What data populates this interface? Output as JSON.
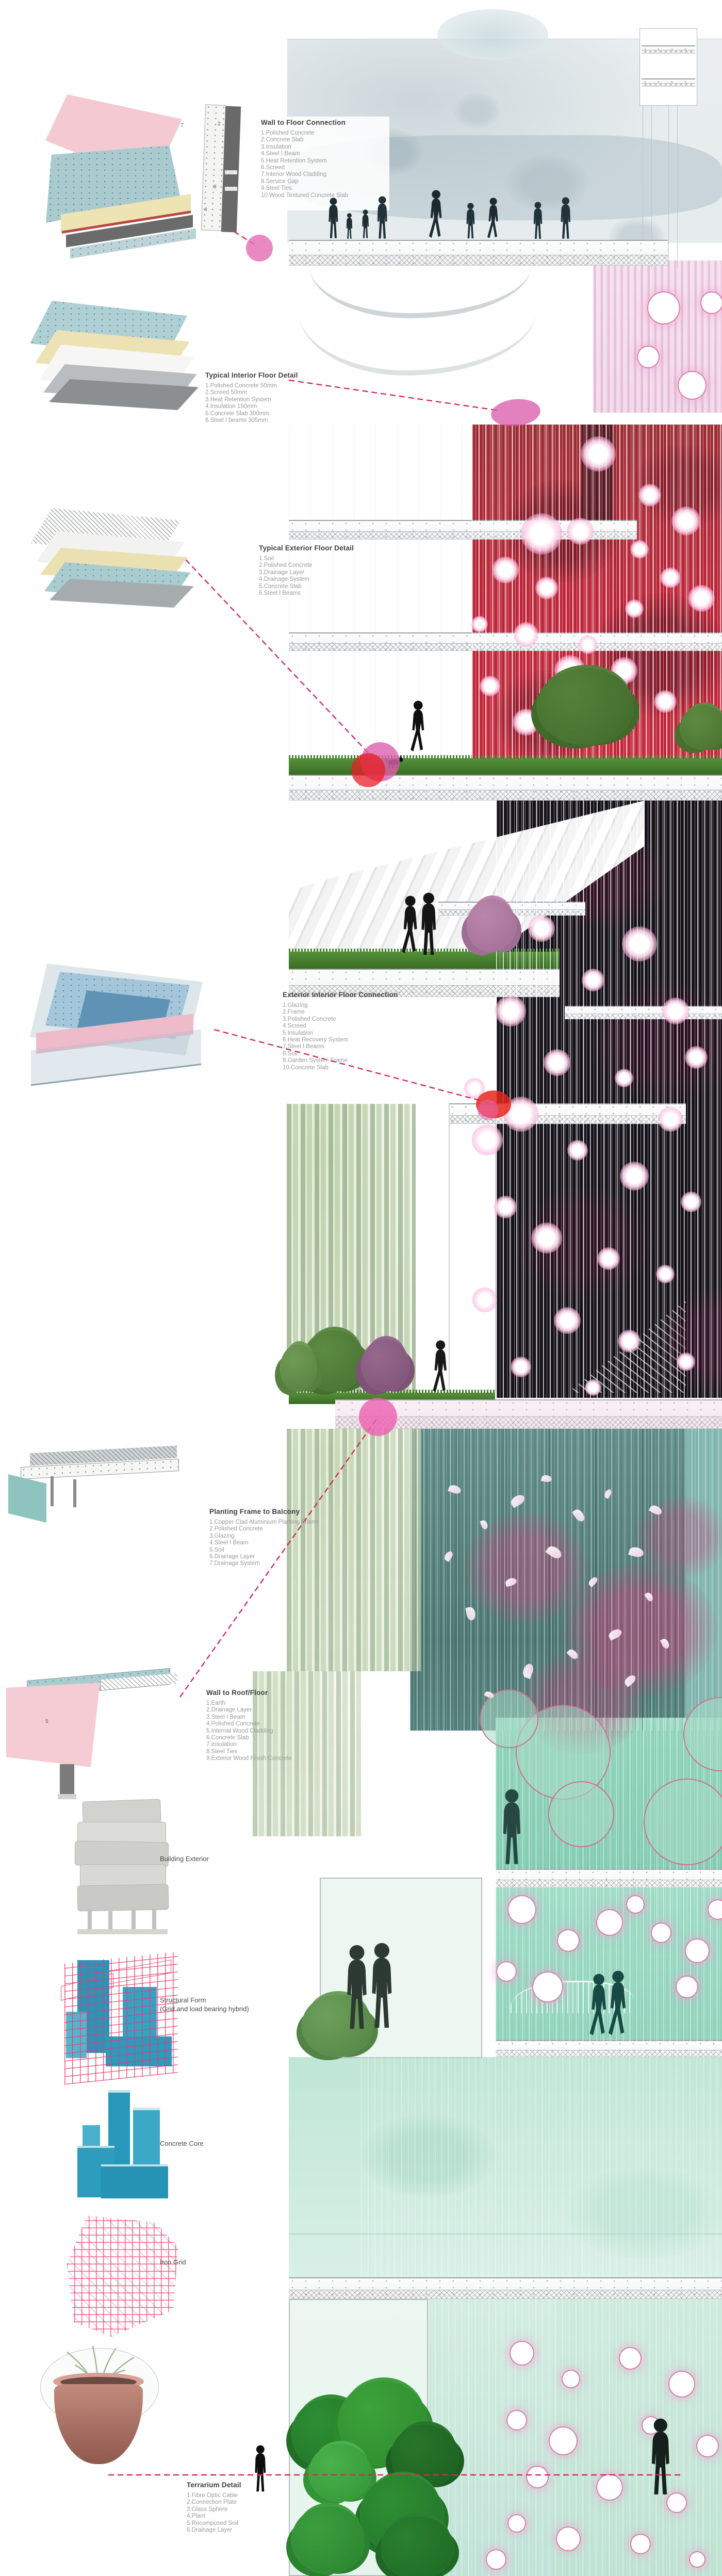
{
  "details": [
    {
      "id": "wall-floor",
      "title": "Wall to Floor Connection",
      "items": [
        "1.Polished Concrete",
        "2.Concrete Slab",
        "3.Insulation",
        "4.Steel I Beam",
        "5.Heat Retention System",
        "6.Screed",
        "7.Interior Wood Cladding",
        "8.Service Gap",
        "9.Steel Ties",
        "10.Wood Textured Concrete Slab"
      ],
      "figure_numbers": [
        "7",
        "2",
        "9",
        "4"
      ]
    },
    {
      "id": "interior-floor",
      "title": "Typical Interior Floor Detail",
      "items": [
        "1.Polished Concrete 50mm",
        "2.Screed 50mm",
        "3.Heat Retention System",
        "4.Insulation 150mm",
        "5.Concrete Slab 300mm",
        "6.Steel I beams 305mm"
      ],
      "figure_numbers": []
    },
    {
      "id": "exterior-floor",
      "title": "Typical Exterior Floor Detail",
      "items": [
        "1.Soil",
        "2.Polished Concrete",
        "3.Drainage Layer",
        "4.Drainage System",
        "5.Concrete Slab",
        "6.Steel I Beams"
      ],
      "figure_numbers": []
    },
    {
      "id": "ext-int-connection",
      "title": "Exterior Interior Floor Connection",
      "items": [
        "1.Glazing",
        "2.Frame",
        "3.Polished Concrete",
        "4.Screed",
        "5.Insulation",
        "6.Heat Recovery System",
        "7.Steel I Beams",
        "8.Soil",
        "9.Garden System Frame",
        "10.Concrete Slab"
      ],
      "figure_numbers": []
    },
    {
      "id": "planting-frame",
      "title": "Planting Frame to Balcony",
      "items": [
        "1.Copper Clad Aluminium Planting Frame",
        "2.Polished Concrete",
        "3.Glazing",
        "4.Steel I Beam",
        "5.Soil",
        "6.Drainage Layer",
        "7.Drainage System"
      ],
      "figure_numbers": []
    },
    {
      "id": "wall-roof",
      "title": "Wall to Roof/Floor",
      "items": [
        "1.Earth",
        "2.Drainage Layer",
        "3.Steel I Beam",
        "4.Polished Concrete",
        "5.Internal Wood Cladding",
        "6.Concrete Slab",
        "7.Insulation",
        "8.Steel Ties",
        "9.Exterior Wood Finish Concrete"
      ],
      "figure_numbers": [
        "5"
      ]
    },
    {
      "id": "terrarium",
      "title": "Terrarium Detail",
      "items": [
        "1.Fibre Optic Cable",
        "2.Connection Plate",
        "3.Glass Sphere",
        "4.Plant",
        "5.Recomposed Soil",
        "6.Drainage Layer"
      ],
      "figure_numbers": []
    }
  ],
  "axon_stack": [
    {
      "label": "Building Exterior",
      "sublabel": ""
    },
    {
      "label": "Structural Form",
      "sublabel": "(Grid and load bearing hybrid)"
    },
    {
      "label": "Concrete Core",
      "sublabel": ""
    },
    {
      "label": "Iron Grid",
      "sublabel": ""
    }
  ],
  "colors": {
    "leader_dash": "#cf2a5c",
    "callout_pink": "#e36bb4",
    "callout_red": "#e6261f",
    "red_glass": "#b02837",
    "black_glass": "#16121a",
    "teal_room": "#55807b",
    "mint_room": "#8fd3ba",
    "structure_teal": "#2a9aba",
    "grid_red": "#e84a6e"
  }
}
